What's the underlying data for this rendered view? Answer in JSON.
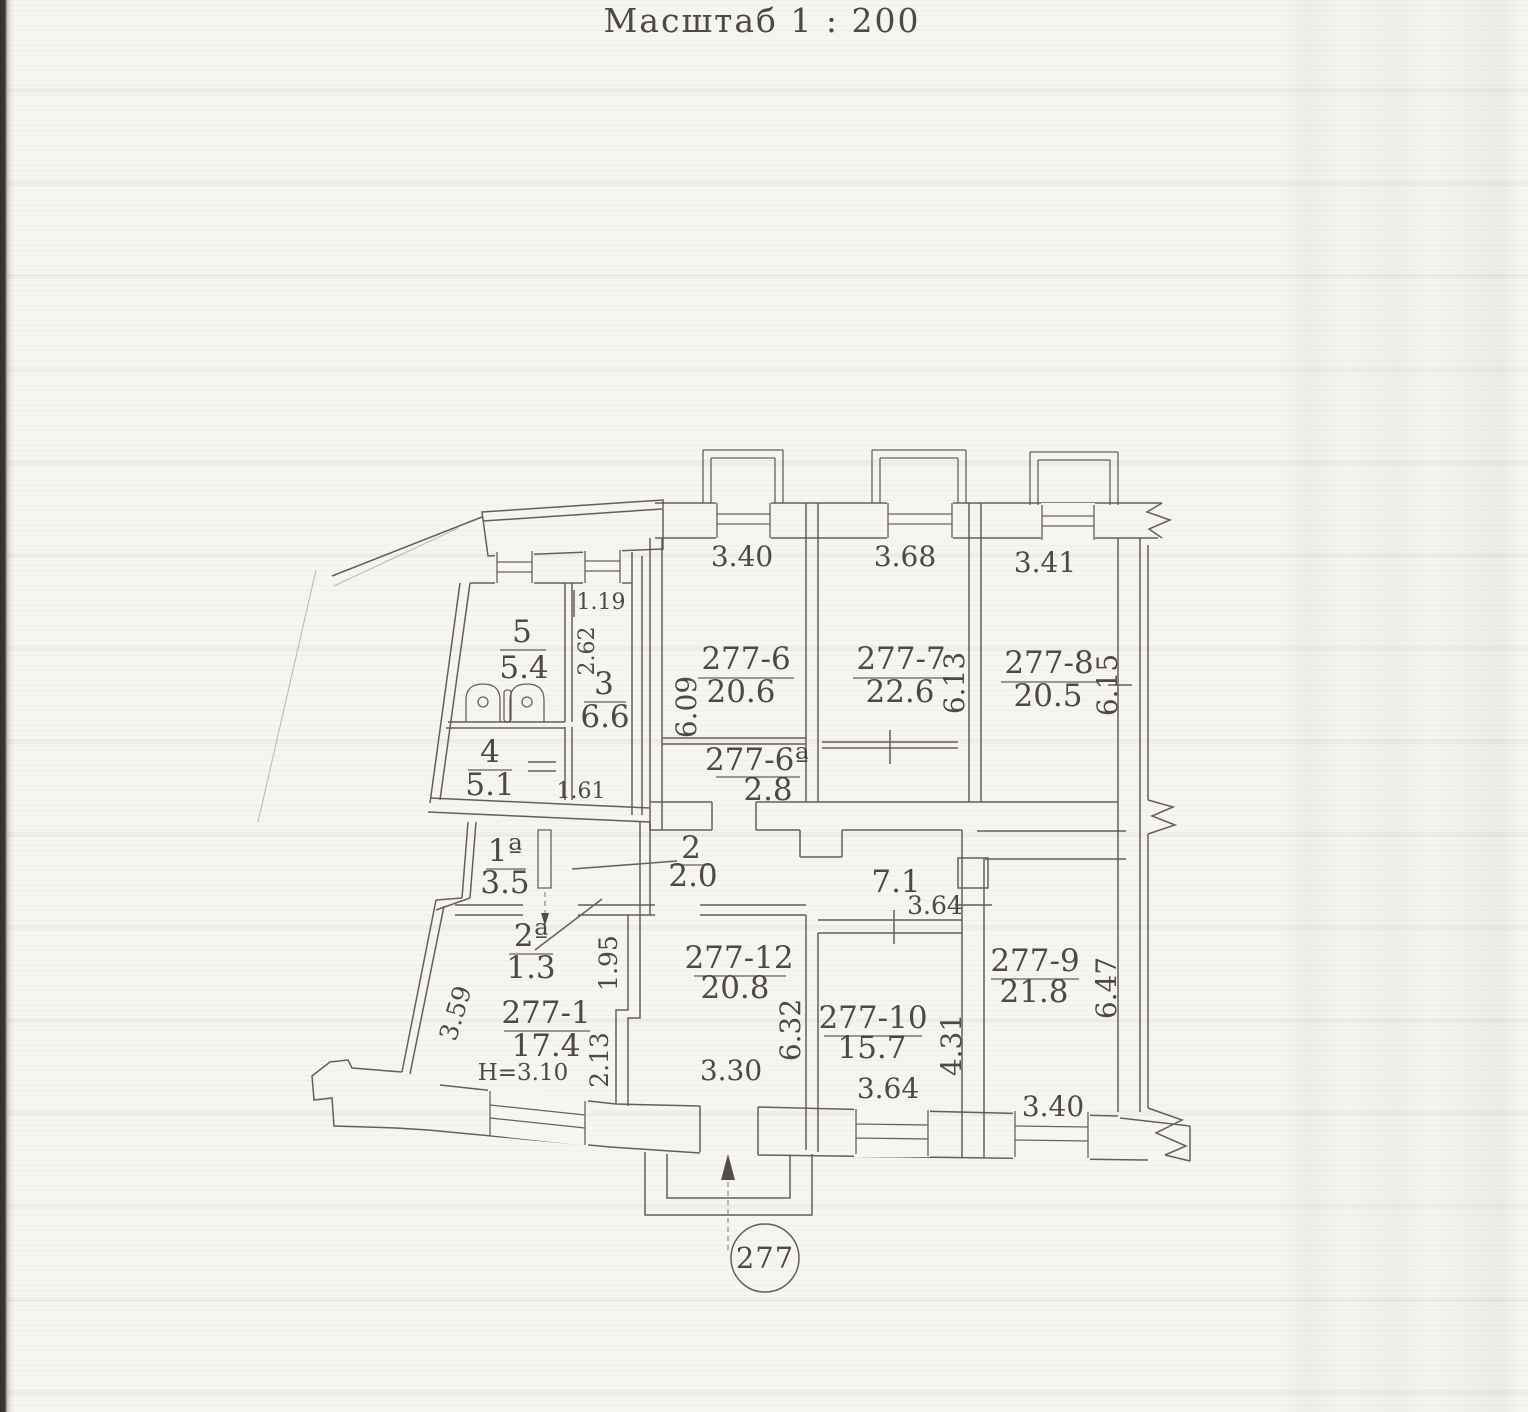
{
  "title": "Масштаб 1 : 200",
  "stamp": {
    "number": "277"
  },
  "notes": {
    "ceiling_height": "Н=3.10"
  },
  "rooms": {
    "r5": {
      "num": "5",
      "area": "5.4"
    },
    "r3": {
      "num": "3",
      "area": "6.6"
    },
    "r4": {
      "num": "4",
      "area": "5.1"
    },
    "r1a": {
      "num": "1ª",
      "area": "3.5"
    },
    "r2a": {
      "num": "2ª",
      "area": "1.3"
    },
    "r2": {
      "num": "2",
      "area": "2.0"
    },
    "r277_1": {
      "num": "277-1",
      "area": "17.4"
    },
    "r277_6": {
      "num": "277-6",
      "area": "20.6"
    },
    "r277_6a": {
      "num": "277-6ª",
      "area": "2.8"
    },
    "r277_7": {
      "num": "277-7",
      "area": "22.6"
    },
    "r277_8": {
      "num": "277-8",
      "area": "20.5"
    },
    "r277_9": {
      "num": "277-9",
      "area": "21.8"
    },
    "r277_10": {
      "num": "277-10",
      "area": "15.7"
    },
    "r277_12": {
      "num": "277-12",
      "area": "20.8"
    },
    "corridor": {
      "area": "7.1"
    }
  },
  "dims": {
    "top_6": "3.40",
    "top_7": "3.68",
    "top_8": "3.41",
    "left_6": "6.09",
    "right_7": "6.13",
    "right_8": "6.15",
    "small_119": "1.19",
    "small_262": "2.62",
    "small_161": "1.61",
    "left_1": "3.59",
    "right_12a": "1.95",
    "right_12b": "2.13",
    "top_10": "3.64",
    "right_12": "6.32",
    "right_10": "4.31",
    "right_9": "6.47",
    "bottom_12": "3.30",
    "bottom_10": "3.64",
    "bottom_9": "3.40"
  },
  "colors": {
    "ink": "#4e4942",
    "paper": "#f6f5f1"
  }
}
